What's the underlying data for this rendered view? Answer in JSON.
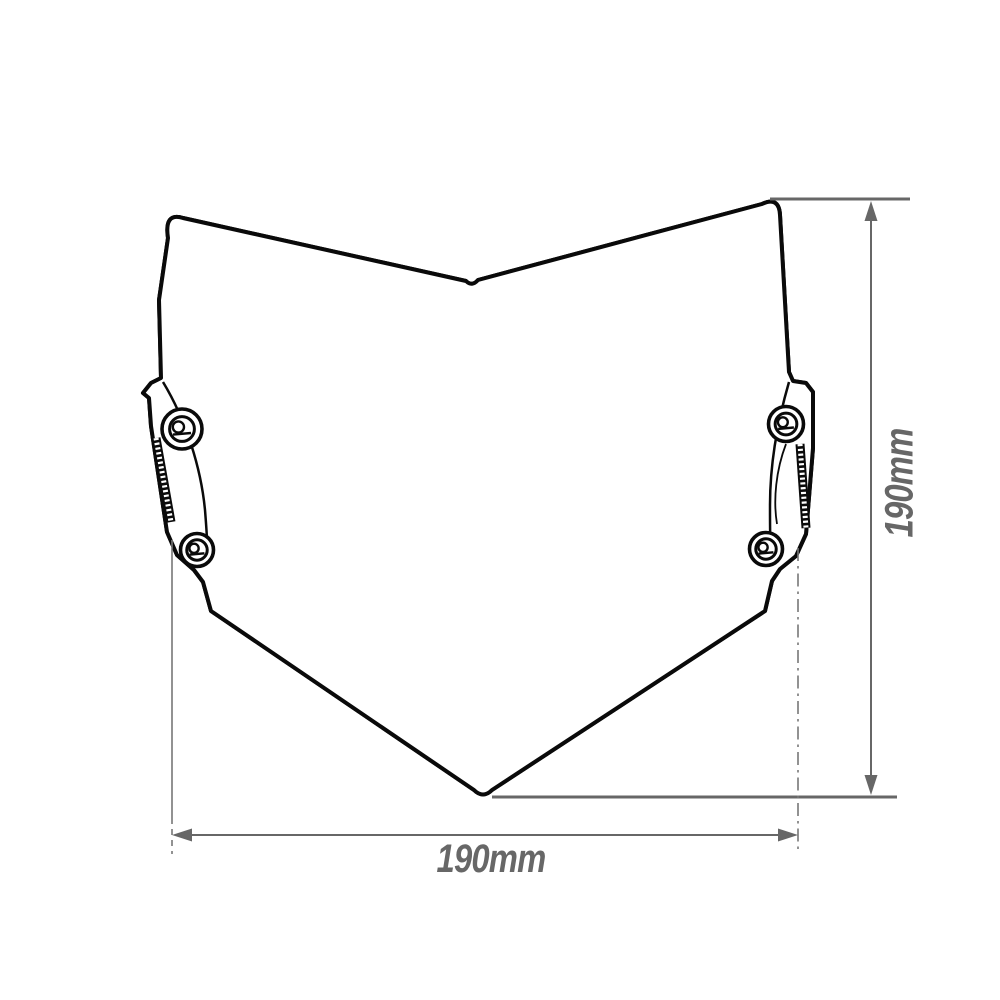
{
  "diagram": {
    "width_dimension": {
      "label": "190mm"
    },
    "height_dimension": {
      "label": "190mm"
    }
  },
  "colors": {
    "line": "#0a0a0a",
    "dimension": "#676767",
    "background": "#ffffff",
    "fill": "#ffffff"
  }
}
